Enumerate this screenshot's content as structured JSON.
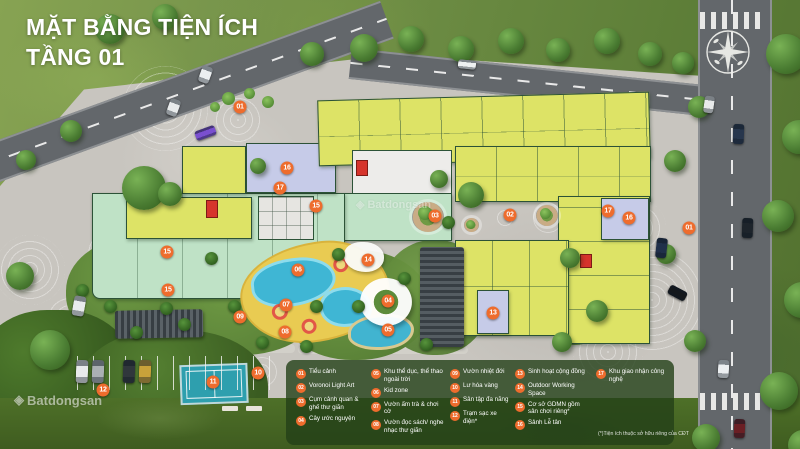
{
  "title": {
    "line1": "MẶT BẰNG TIỆN ÍCH",
    "line2": "TẦNG 01"
  },
  "legend": {
    "columns": [
      {
        "items": [
          {
            "num": "01",
            "label": "Tiểu cảnh"
          },
          {
            "num": "02",
            "label": "Voronoi Light Art"
          },
          {
            "num": "03",
            "label": "Cụm cảnh quan & ghế thư giãn"
          },
          {
            "num": "04",
            "label": "Cây ước nguyện"
          }
        ]
      },
      {
        "items": [
          {
            "num": "05",
            "label": "Khu thể dục, thể thao ngoài trời"
          },
          {
            "num": "06",
            "label": "Kid zone"
          },
          {
            "num": "07",
            "label": "Vườn ấm trà & chơi cờ"
          },
          {
            "num": "08",
            "label": "Vườn đọc sách/ nghe nhạc thư giãn"
          }
        ]
      },
      {
        "items": [
          {
            "num": "09",
            "label": "Vườn nhiệt đới"
          },
          {
            "num": "10",
            "label": "Lư hóa vàng"
          },
          {
            "num": "11",
            "label": "Sân tập đa năng"
          },
          {
            "num": "12",
            "label": "Trạm sạc xe điện*"
          }
        ]
      },
      {
        "items": [
          {
            "num": "13",
            "label": "Sinh hoạt cộng đồng"
          },
          {
            "num": "14",
            "label": "Outdoor Working Space"
          },
          {
            "num": "15",
            "label": "Cơ sở GDMN gồm sân chơi riêng*"
          },
          {
            "num": "16",
            "label": "Sảnh Lễ tân"
          }
        ]
      },
      {
        "items": [
          {
            "num": "17",
            "label": "Khu giao nhận công nghệ"
          }
        ]
      }
    ],
    "footnote": "(*)Tiện ích thuộc sở hữu riêng của CĐT"
  },
  "markers": [
    {
      "num": "01",
      "x": 240,
      "y": 107
    },
    {
      "num": "16",
      "x": 287,
      "y": 168
    },
    {
      "num": "17",
      "x": 280,
      "y": 188
    },
    {
      "num": "15",
      "x": 316,
      "y": 206
    },
    {
      "num": "15",
      "x": 167,
      "y": 252
    },
    {
      "num": "15",
      "x": 168,
      "y": 290
    },
    {
      "num": "03",
      "x": 435,
      "y": 216
    },
    {
      "num": "02",
      "x": 510,
      "y": 215
    },
    {
      "num": "17",
      "x": 608,
      "y": 211
    },
    {
      "num": "16",
      "x": 629,
      "y": 218
    },
    {
      "num": "01",
      "x": 689,
      "y": 228
    },
    {
      "num": "06",
      "x": 298,
      "y": 270
    },
    {
      "num": "14",
      "x": 368,
      "y": 260
    },
    {
      "num": "04",
      "x": 388,
      "y": 301
    },
    {
      "num": "05",
      "x": 388,
      "y": 330
    },
    {
      "num": "07",
      "x": 286,
      "y": 305
    },
    {
      "num": "09",
      "x": 240,
      "y": 317
    },
    {
      "num": "08",
      "x": 285,
      "y": 332
    },
    {
      "num": "13",
      "x": 493,
      "y": 313
    },
    {
      "num": "10",
      "x": 258,
      "y": 373
    },
    {
      "num": "11",
      "x": 213,
      "y": 382
    },
    {
      "num": "12",
      "x": 103,
      "y": 390
    }
  ],
  "watermark": {
    "text": "Batdongsan",
    "logo": "◈"
  },
  "colors": {
    "marker_orange": "#EE6C2D",
    "building_yellow": "#DDE366",
    "building_mint": "#BFE2C6",
    "building_lavender": "#C6CBE8",
    "core_red": "#D6342C",
    "pool_blue": "#3FB6D4",
    "legend_bg": "rgba(35,64,24,0.8)"
  }
}
